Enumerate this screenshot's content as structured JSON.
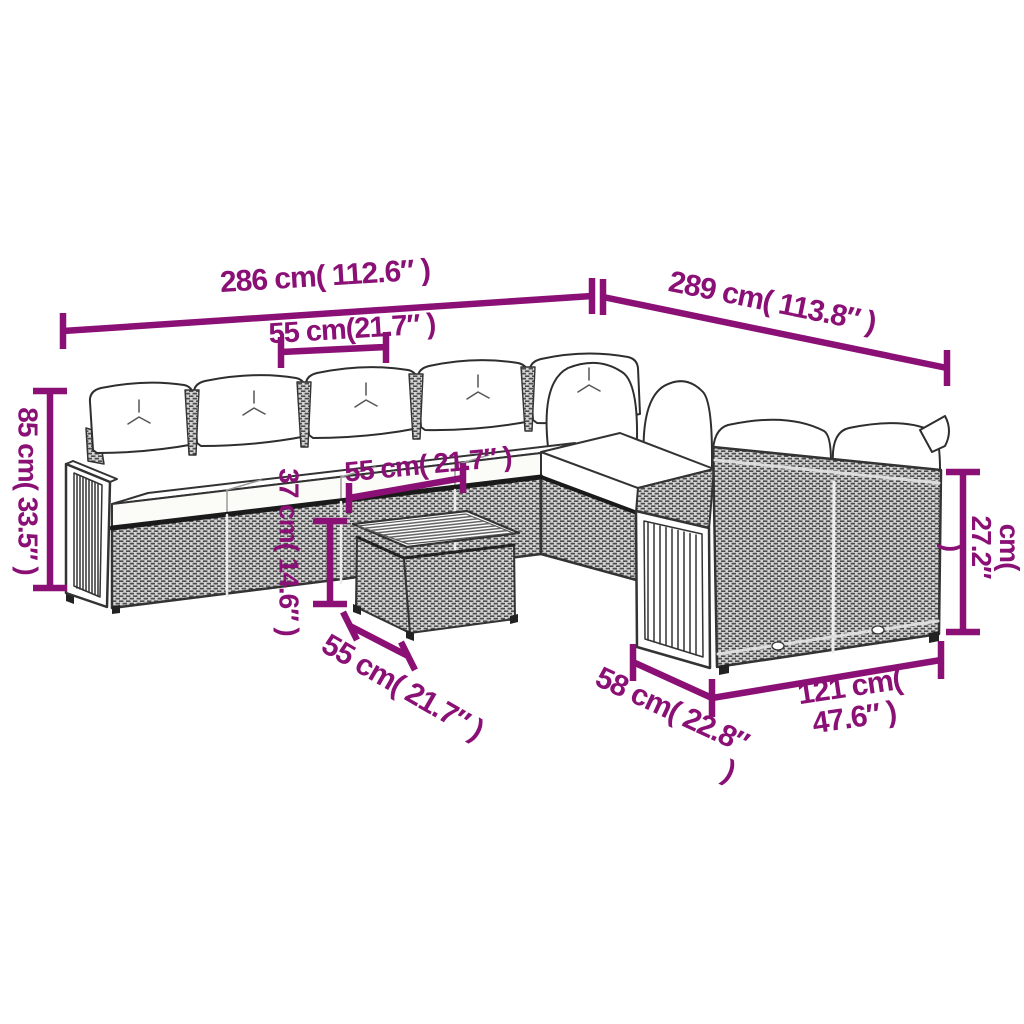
{
  "style": {
    "background": "#ffffff",
    "annotation_color": "#8B1076",
    "line_art_color": "#333333",
    "rattan_fill": "#d4d4d4",
    "cushion_fill": "#ffffff"
  },
  "figure": {
    "kind": "product-dimension-diagram",
    "subject": "corner-garden-lounge-set-with-coffee-table"
  },
  "dims": {
    "d286": {
      "label": "286 cm( 112.6″ )"
    },
    "d289": {
      "label": "289 cm( 113.8″ )"
    },
    "d55_top": {
      "label": "55 cm(21.7″ )"
    },
    "d85": {
      "label": "85 cm( 33.5″ )"
    },
    "d37": {
      "label": "37 cm( 14.6″ )"
    },
    "d55_mid": {
      "label": "55 cm( 21.7″ )"
    },
    "d55_table": {
      "label": "55 cm( 21.7″ )"
    },
    "d69": {
      "label": "69 cm( 27.2″ )"
    },
    "d58": {
      "label": "58 cm( 22.8″\n)"
    },
    "d121": {
      "label": "121 cm( 47.6″ )"
    }
  }
}
